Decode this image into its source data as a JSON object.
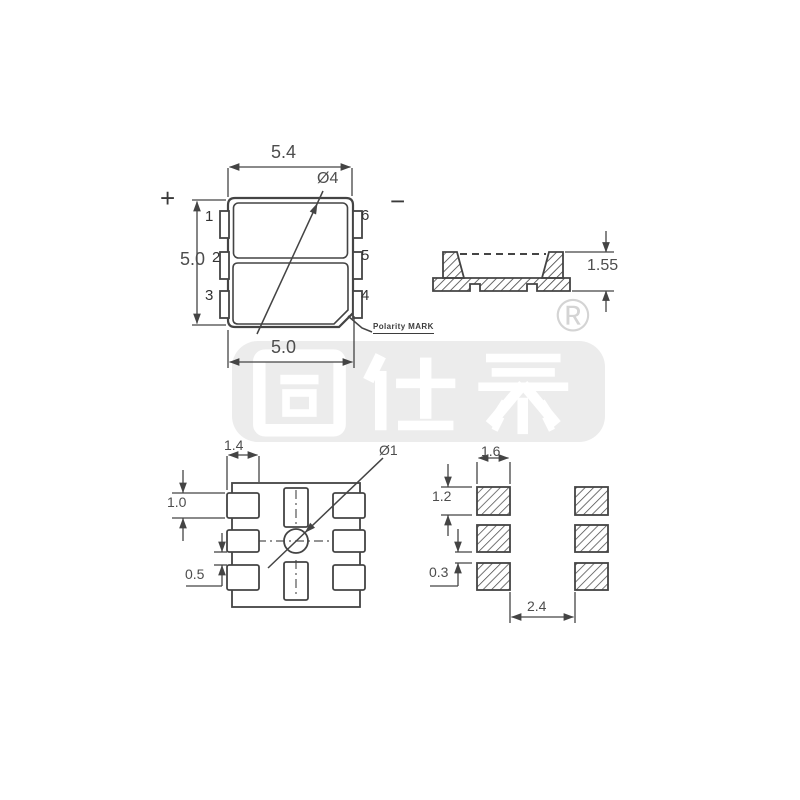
{
  "drawing": {
    "top_view": {
      "polarity_positive": "+",
      "polarity_negative": "−",
      "dim_top_width": "5.4",
      "dim_left_height": "5.0",
      "dim_bottom_width": "5.0",
      "lens_diameter": "Ø4",
      "pin_labels_left": [
        "1",
        "2",
        "3"
      ],
      "pin_labels_right": [
        "6",
        "5",
        "4"
      ],
      "polarity_mark_label": "Polarity MARK"
    },
    "side_view": {
      "dim_height": "1.55"
    },
    "bottom_view": {
      "dim_pad_width": "1.4",
      "dim_pad_height": "1.0",
      "dim_pad_gap": "0.5",
      "center_hole_diameter": "Ø1"
    },
    "pad_layout": {
      "dim_pad_width": "1.6",
      "dim_pad_height": "1.2",
      "dim_pad_gap": "0.3",
      "dim_column_spacing": "2.4"
    }
  },
  "watermark": {
    "brand_text": "固仕泰",
    "registered_symbol": "®"
  },
  "colors": {
    "line": "#444444",
    "dimension_text": "#4d4d4d",
    "watermark_gray": "#ececec",
    "watermark_text": "#ffffff"
  }
}
